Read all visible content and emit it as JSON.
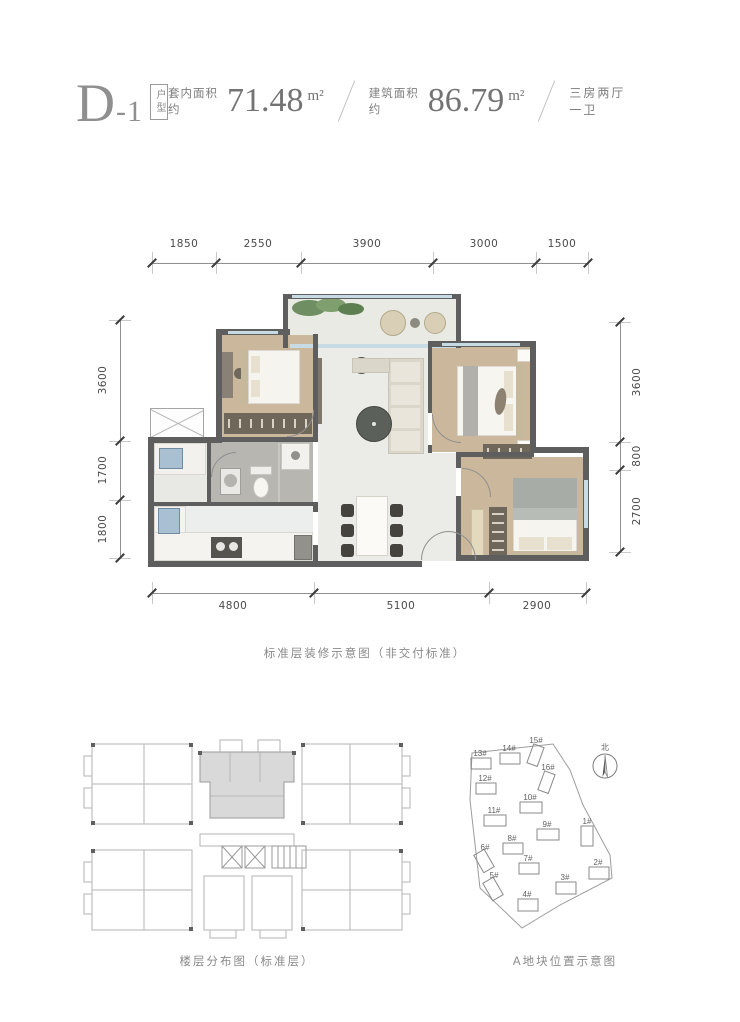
{
  "header": {
    "unit_code": "D-1",
    "unit_tag": "户型",
    "metrics": [
      {
        "label": "套内面积约",
        "value": "71.48",
        "unit": "m²"
      },
      {
        "label": "建筑面积约",
        "value": "86.79",
        "unit": "m²"
      }
    ],
    "layout_desc": "三房两厅一卫"
  },
  "floor_plan": {
    "caption": "标准层装修示意图（非交付标准）",
    "dims_top": [
      "1850",
      "2550",
      "3900",
      "3000",
      "1500"
    ],
    "dims_bottom": [
      "4800",
      "5100",
      "2900"
    ],
    "dims_left": [
      "3600",
      "1700",
      "1800"
    ],
    "dims_right": [
      "3600",
      "800",
      "2700"
    ]
  },
  "floor_distribution": {
    "caption": "楼层分布图（标准层）"
  },
  "site_plan": {
    "caption": "A地块位置示意图",
    "north_label": "北",
    "buildings": [
      {
        "label": "1#"
      },
      {
        "label": "2#"
      },
      {
        "label": "3#"
      },
      {
        "label": "4#"
      },
      {
        "label": "5#"
      },
      {
        "label": "6#"
      },
      {
        "label": "7#"
      },
      {
        "label": "8#"
      },
      {
        "label": "9#"
      },
      {
        "label": "10#"
      },
      {
        "label": "11#"
      },
      {
        "label": "12#"
      },
      {
        "label": "13#"
      },
      {
        "label": "14#"
      },
      {
        "label": "15#"
      },
      {
        "label": "16#"
      }
    ]
  },
  "colors": {
    "wall": "#5e5e5e",
    "wood_floor": "#cbb89c",
    "tile_floor": "#ebebe7",
    "glass": "#c7dbe4",
    "highlight_unit": "#d9d9d9"
  }
}
